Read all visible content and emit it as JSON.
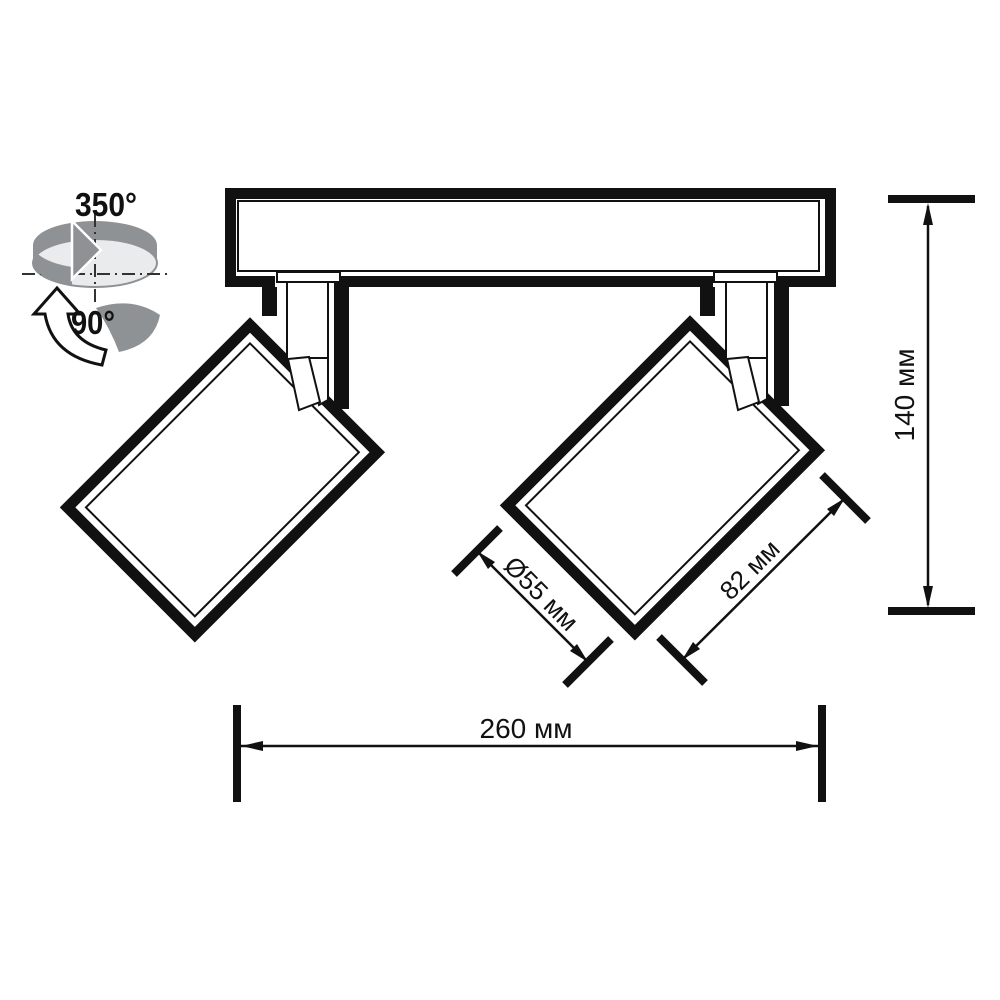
{
  "title": "Spotlight dimension drawing",
  "rotation_icon": {
    "rotation_label": "350°",
    "tilt_label": "90°"
  },
  "dimensions": {
    "height": "140 мм",
    "width": "260 мм",
    "diameter": "Ø55 мм",
    "head_length": "82 мм"
  },
  "colors": {
    "ink": "#111111",
    "arrow_gray": "#8e9294",
    "disc_light": "#eaebec",
    "background": "#ffffff"
  }
}
